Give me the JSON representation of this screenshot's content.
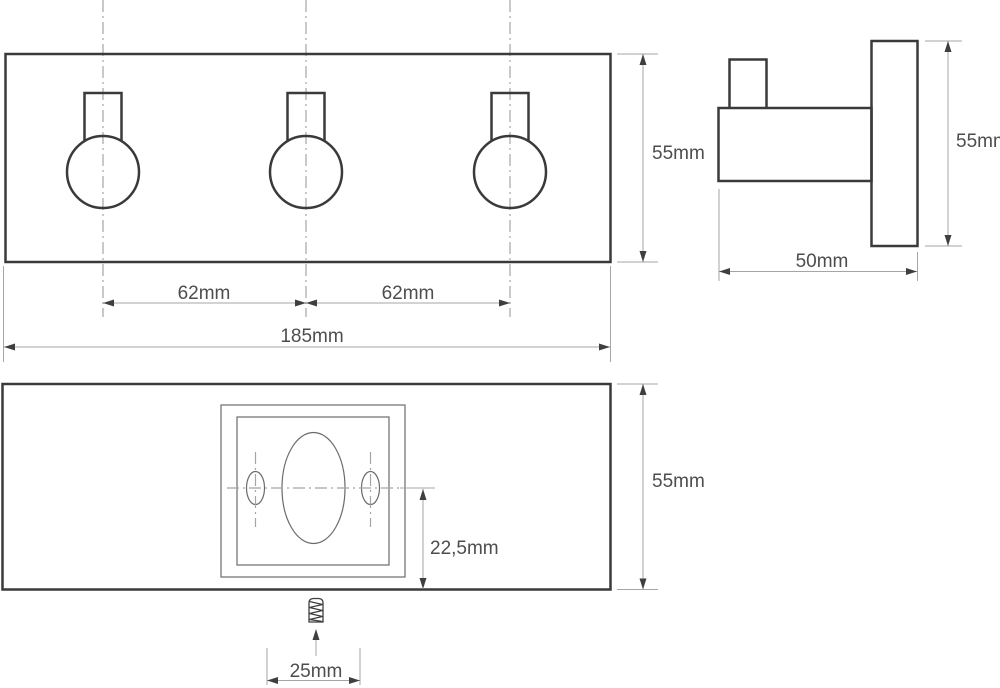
{
  "drawing": {
    "kind": "technical-dimension-drawing",
    "subject": "triple-wall-hook",
    "views": {
      "front": {
        "dimensions": {
          "height": "55mm",
          "hook_pitch_left": "62mm",
          "hook_pitch_right": "62mm",
          "total_width": "185mm"
        }
      },
      "side": {
        "dimensions": {
          "height": "55mm",
          "depth": "50mm"
        }
      },
      "back": {
        "dimensions": {
          "height": "55mm",
          "hole_center_offset": "22,5mm",
          "screw_spacing": "25mm"
        }
      }
    }
  },
  "colors": {
    "background": "#ffffff",
    "outline": "#3a3a3a",
    "thin_line": "#6b6b6b",
    "dim_line": "#a5a5a5",
    "arrow": "#3f3f3f",
    "text": "#4d4d4d",
    "centerline": "#a5a5a5"
  }
}
